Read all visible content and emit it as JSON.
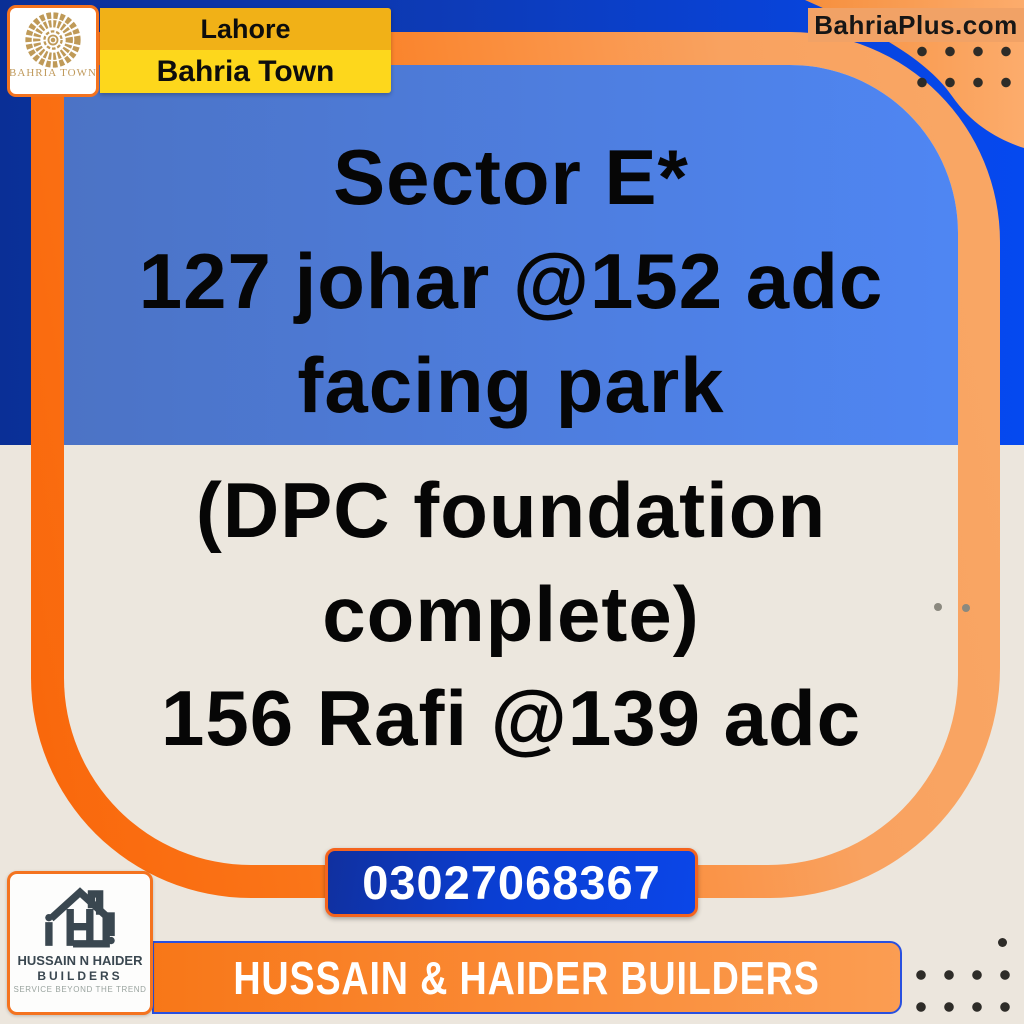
{
  "brand": {
    "bahria_logo_text": "BAHRIA TOWN",
    "website": "BahriaPlus.com"
  },
  "location": {
    "city": "Lahore",
    "community": "Bahria Town"
  },
  "listing": {
    "lines_on_blue": [
      "Sector E*",
      "127 johar @152 adc",
      "facing park"
    ],
    "lines_on_beige": [
      "(DPC foundation",
      "complete)",
      "156 Rafi @139 adc"
    ]
  },
  "contact": {
    "phone": "03027068367"
  },
  "builder": {
    "name_line1": "HUSSAIN N HAIDER",
    "name_line2": "BUILDERS",
    "tagline": "SERVICE BEYOND THE TREND",
    "banner": "HUSSAIN & HAIDER BUILDERS"
  },
  "colors": {
    "navy_bg": "#0a2f96",
    "bright_blue_bg": "#0549f0",
    "panel_blue_left": "#4c73c5",
    "panel_blue_right": "#4f86f3",
    "beige": "#ece6dd",
    "frame_orange_start": "#f9660a",
    "frame_orange_end": "#f9a765",
    "corner_orange": "#f68f3d",
    "website_strip_orange": "#f1a266",
    "yellow_top": "#f1b117",
    "yellow_bottom": "#fdd71c",
    "button_blue": "#0b46e8",
    "button_border_orange": "#f4641e",
    "banner_orange": "#f87718",
    "banner_border_blue": "#2850e0",
    "gold": "#bf9a58",
    "slate": "#3a4750",
    "text_black": "#060606"
  }
}
